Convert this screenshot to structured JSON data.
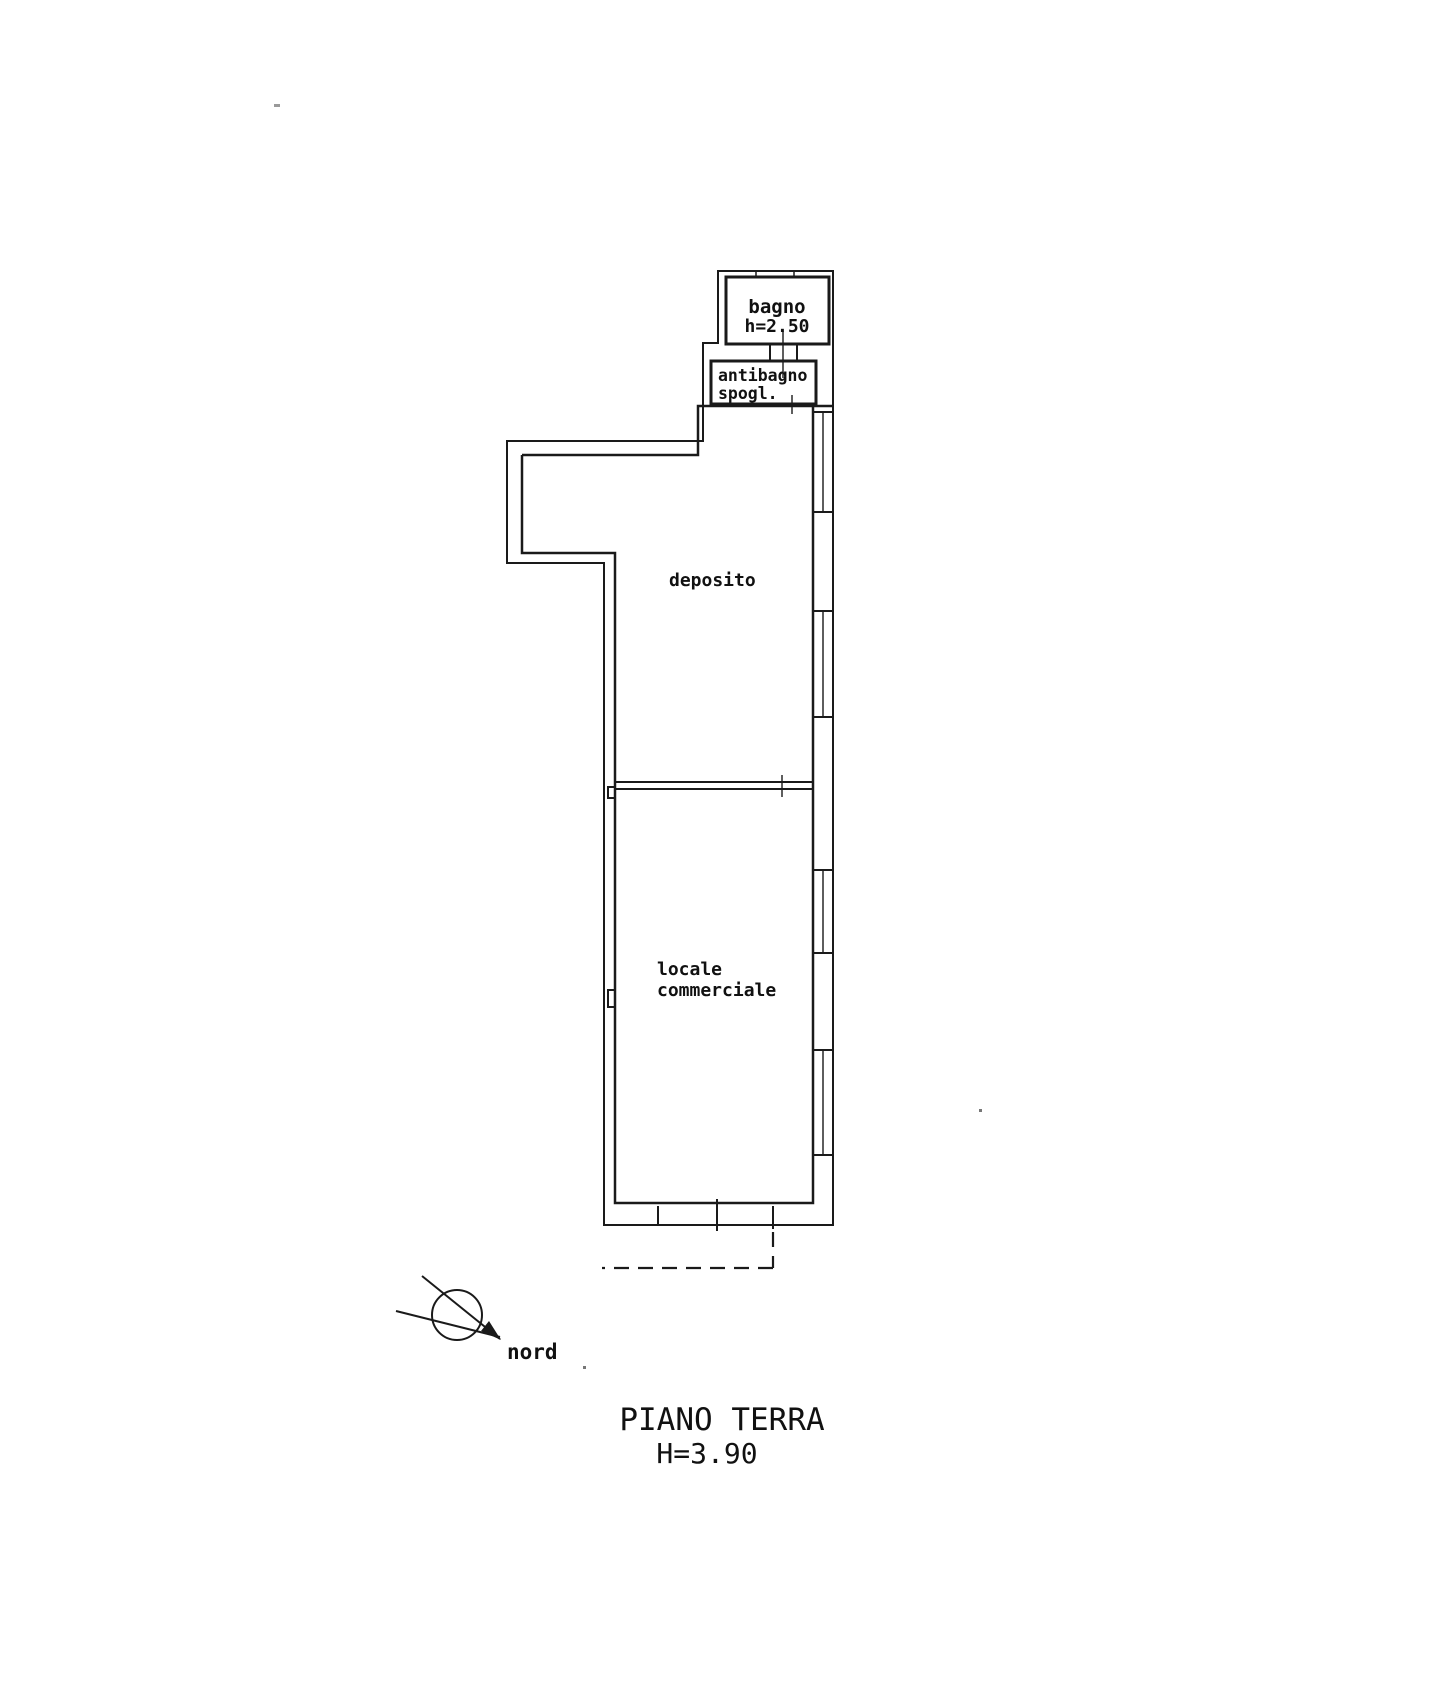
{
  "page": {
    "background": "#ffffff",
    "ink_color": "#1a1a1a"
  },
  "plan": {
    "rooms": [
      {
        "name": "bagno",
        "height_note": "h=2.50"
      },
      {
        "name": "antibagno",
        "sub": "spogl."
      },
      {
        "name": "deposito"
      },
      {
        "name": "locale",
        "sub": "commerciale"
      }
    ],
    "north": {
      "label": "nord"
    },
    "title": {
      "line1": "PIANO TERRA",
      "line2": "H=3.90"
    }
  }
}
